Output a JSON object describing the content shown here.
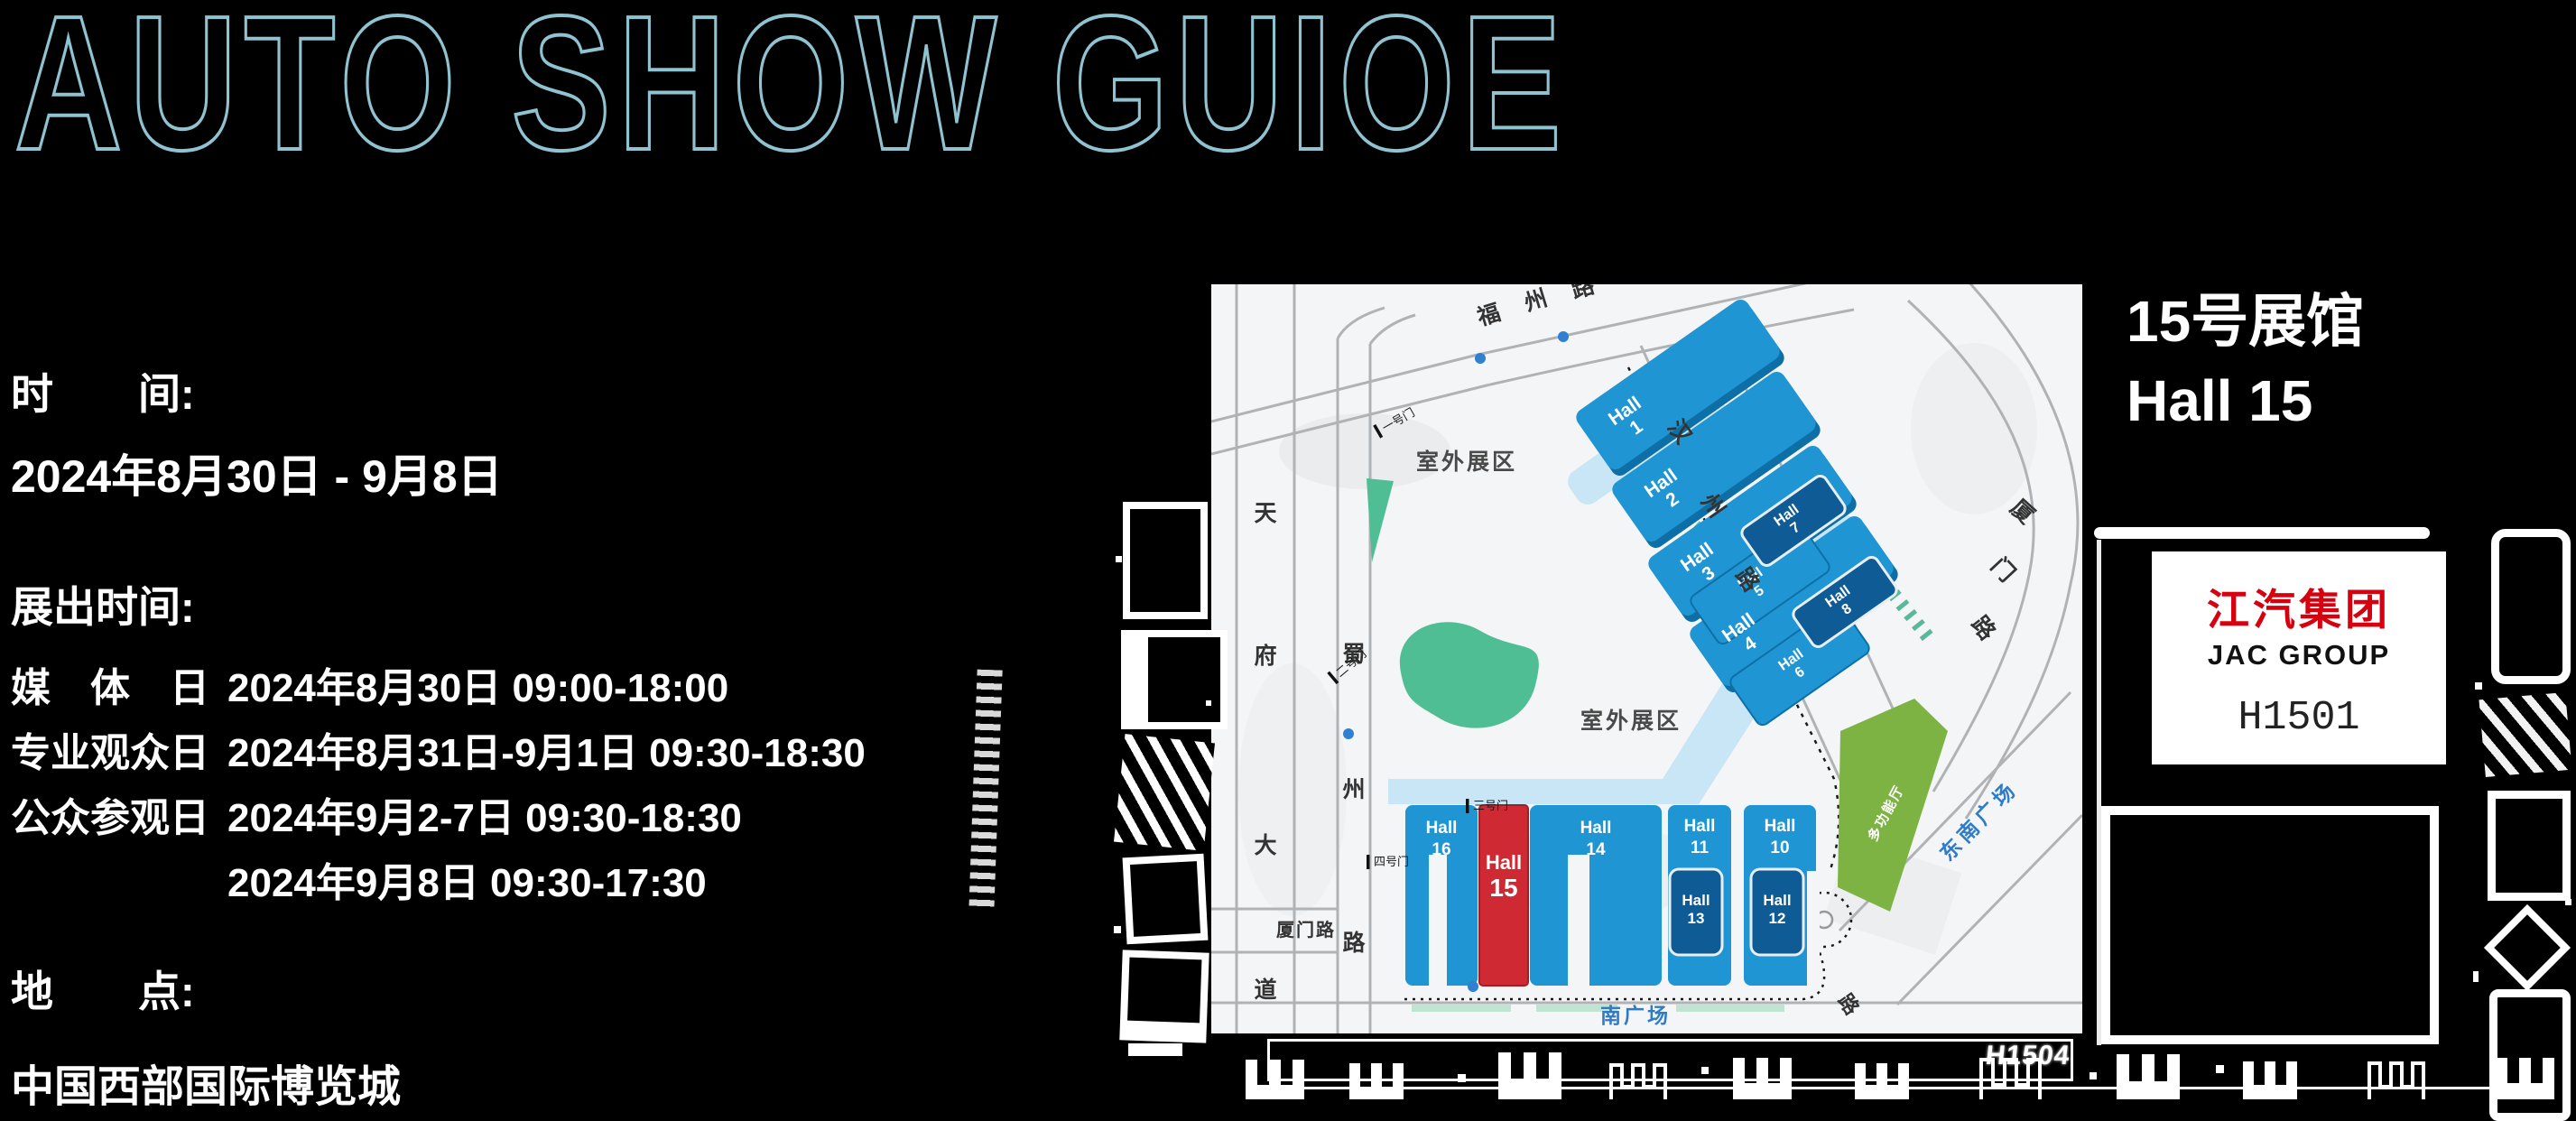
{
  "header": {
    "title": "AUTO SHOW GUIOE"
  },
  "info": {
    "time_label": "时　　间:",
    "time_value": "2024年8月30日 - 9月8日",
    "hours_label": "展出时间:",
    "rows": [
      {
        "label": "媒　体　日",
        "value": "2024年8月30日  09:00-18:00"
      },
      {
        "label": "专业观众日",
        "value": "2024年8月31日-9月1日  09:30-18:30"
      },
      {
        "label": "公众参观日",
        "value": "2024年9月2-7日  09:30-18:30"
      },
      {
        "label": "",
        "value": "2024年9月8日  09:30-17:30"
      }
    ],
    "place_label": "地　　点:",
    "place_value": "中国西部国际博览城"
  },
  "map": {
    "hall_word": "Hall",
    "halls": {
      "h1": "1",
      "h2": "2",
      "h3": "3",
      "h4": "4",
      "h5": "5",
      "h6": "6",
      "h7": "7",
      "h8": "8",
      "h10": "10",
      "h11": "11",
      "h12": "12",
      "h13": "13",
      "h14": "14",
      "h15": "15",
      "h16": "16"
    },
    "roads": {
      "fuzhou": [
        "福",
        "州",
        "路"
      ],
      "hanzhou": [
        "汉",
        "州",
        "路"
      ],
      "tianfu": [
        "天",
        "府",
        "大",
        "道"
      ],
      "shuzhou": [
        "蜀",
        "州",
        "路"
      ],
      "xiamen_left": "厦门路",
      "xiamen_right": [
        "厦",
        "门",
        "路"
      ],
      "bottom_road_char": "路"
    },
    "areas": {
      "outdoor": "室外展区",
      "south_plaza": "南广场",
      "southeast_plaza": "东南广场",
      "multi_function": "多功能厅"
    },
    "gates": {
      "g1": "一号门",
      "g2": "二号门",
      "g3": "三号门",
      "g4": "四号门"
    },
    "bar_label": "H1504"
  },
  "booth": {
    "hall_title_cn": "15号展馆",
    "hall_title_en": "Hall 15",
    "logo_cn": "江汽集团",
    "logo_en": "JAC GROUP",
    "booth_no": "H1501"
  },
  "colors": {
    "title_outline": "#8FC3D1",
    "hall_blue": "#1F96D3",
    "hall_dark_blue": "#0F5B96",
    "hall_red": "#CF2A33",
    "green_area": "#7CB342",
    "pond_green": "#4FBE94",
    "water_blue": "#C8E6F5",
    "plaza_label_blue": "#2F7BC8",
    "jac_red": "#D7000F"
  }
}
